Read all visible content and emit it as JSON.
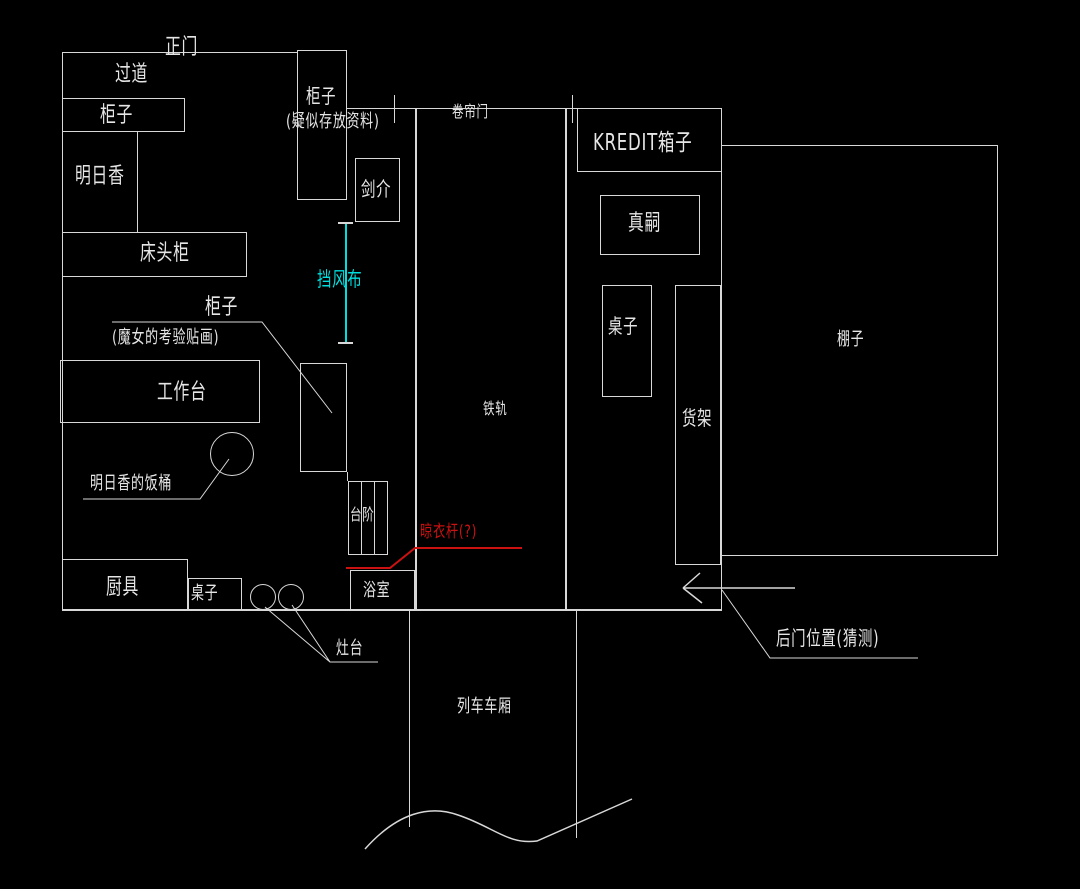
{
  "title": "room floor plan sketch (CAD style)",
  "colors": {
    "background": "#000000",
    "line": "#d8d8d8",
    "text": "#e6e6e6",
    "accent_cyan": "#00dede",
    "accent_red": "#cc1111"
  },
  "labels": {
    "main_door": "正门",
    "corridor": "过道",
    "cabinet_top": "柜子",
    "asuka": "明日香",
    "bedside_cabinet": "床头柜",
    "cabinet_docs_line1": "柜子",
    "cabinet_docs_line2": "(疑似存放资料)",
    "kensuke": "剑介",
    "windbreak_cloth": "挡风布",
    "cabinet_witch_line1": "柜子",
    "cabinet_witch_line2": "(魔女的考验贴画)",
    "workbench": "工作台",
    "asuka_rice_bucket": "明日香的饭桶",
    "kitchenware": "厨具",
    "table_left": "桌子",
    "stove": "灶台",
    "steps": "台阶",
    "bathroom": "浴室",
    "clothes_rod": "晾衣杆(?)",
    "rolling_shutter_door": "卷帘门",
    "rail_track": "铁轨",
    "kredit_box": "KREDIT箱子",
    "shinji": "真嗣",
    "table_right": "桌子",
    "goods_shelf": "货架",
    "shed": "棚子",
    "back_door": "后门位置(猜测)",
    "train_carriage": "列车车厢"
  }
}
